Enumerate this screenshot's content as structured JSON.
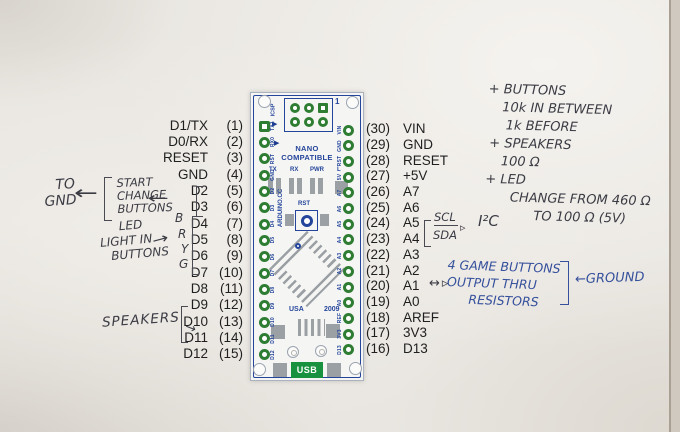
{
  "pinout": {
    "left": [
      {
        "name": "D1/TX",
        "num": "(1)"
      },
      {
        "name": "D0/RX",
        "num": "(2)"
      },
      {
        "name": "RESET",
        "num": "(3)"
      },
      {
        "name": "GND",
        "num": "(4)"
      },
      {
        "name": "D2",
        "num": "(5)"
      },
      {
        "name": "D3",
        "num": "(6)"
      },
      {
        "name": "D4",
        "num": "(7)"
      },
      {
        "name": "D5",
        "num": "(8)"
      },
      {
        "name": "D6",
        "num": "(9)"
      },
      {
        "name": "D7",
        "num": "(10)"
      },
      {
        "name": "D8",
        "num": "(11)"
      },
      {
        "name": "D9",
        "num": "(12)"
      },
      {
        "name": "D10",
        "num": "(13)"
      },
      {
        "name": "D11",
        "num": "(14)"
      },
      {
        "name": "D12",
        "num": "(15)"
      }
    ],
    "right": [
      {
        "num": "(30)",
        "name": "VIN"
      },
      {
        "num": "(29)",
        "name": "GND"
      },
      {
        "num": "(28)",
        "name": "RESET"
      },
      {
        "num": "(27)",
        "name": "+5V"
      },
      {
        "num": "(26)",
        "name": "A7"
      },
      {
        "num": "(25)",
        "name": "A6"
      },
      {
        "num": "(24)",
        "name": "A5"
      },
      {
        "num": "(23)",
        "name": "A4"
      },
      {
        "num": "(22)",
        "name": "A3"
      },
      {
        "num": "(21)",
        "name": "A2"
      },
      {
        "num": "(20)",
        "name": "A1"
      },
      {
        "num": "(19)",
        "name": "A0"
      },
      {
        "num": "(18)",
        "name": "AREF"
      },
      {
        "num": "(17)",
        "name": "3V3"
      },
      {
        "num": "(16)",
        "name": "D13"
      }
    ]
  },
  "board": {
    "silk": {
      "icsp": "ICSP",
      "pin1": "1",
      "name1": "NANO",
      "name2": "COMPATIBLE",
      "leds": [
        "TX",
        "RX",
        "PWR",
        "L"
      ],
      "rst": "RST",
      "maker": "ARDUINO.CC",
      "usa": "USA",
      "year": "2009",
      "usb": "USB",
      "left_edge": [
        "TX1",
        "RX0",
        "RST",
        "GND",
        "D2",
        "D3",
        "D4",
        "D5",
        "D6",
        "D7",
        "D8",
        "D9",
        "D10",
        "D11",
        "D12"
      ],
      "right_edge": [
        "VIN",
        "GND",
        "RST",
        "5V",
        "A7",
        "A6",
        "A5",
        "A4",
        "A3",
        "A2",
        "A1",
        "A0",
        "REF",
        "3V3",
        "D13"
      ]
    },
    "colors": {
      "silkscreen": "#24459b",
      "pad_green": "#2e7d33",
      "usb_green": "#18923f",
      "smd_gray": "#9aa0a4"
    }
  },
  "annotations": {
    "to_gnd": [
      "TO",
      "GND"
    ],
    "to_gnd_arrow": "←",
    "start_change": [
      "START",
      "CHANGE",
      "BUTTONS"
    ],
    "pins_arrow": "←",
    "wire_colors": [
      "B",
      "R",
      "Y",
      "G"
    ],
    "led_light": [
      "LED",
      "LIGHT IN",
      "BUTTONS"
    ],
    "led_arrow": "→",
    "speakers": "SPEAKERS",
    "speakers_arrow": "→",
    "scl": "SCL",
    "sda": "SDA",
    "scl_arrow": "▹",
    "i2c": "I²C",
    "a1_arrows": "↔▹",
    "game": [
      "4 GAME BUTTONS",
      "OUTPUT THRU",
      "RESISTORS"
    ],
    "ground_arrow": "←",
    "ground": "GROUND",
    "notes": [
      "+ BUTTONS",
      "10k IN BETWEEN",
      "1k BEFORE",
      "+ SPEAKERS",
      "100 Ω",
      "+ LED",
      "CHANGE FROM 460 Ω",
      "TO 100 Ω (5V)"
    ]
  }
}
